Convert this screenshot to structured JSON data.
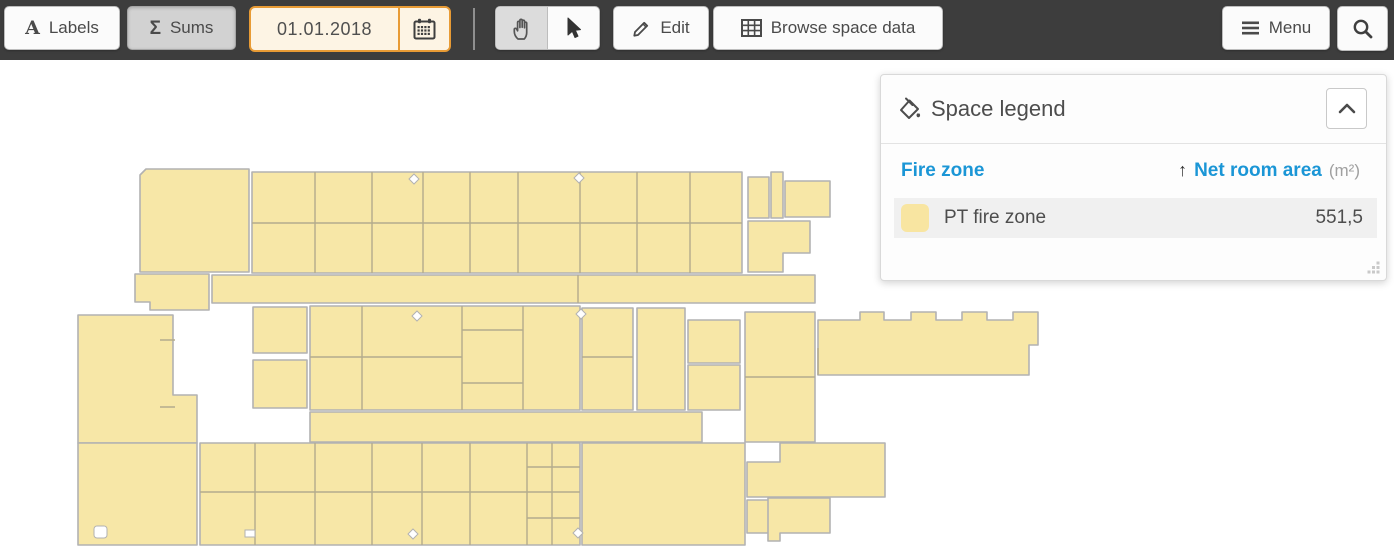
{
  "toolbar": {
    "labels": {
      "icon_glyph": "A",
      "label": "Labels"
    },
    "sums": {
      "icon_glyph": "Σ",
      "label": "Sums"
    },
    "date": {
      "value": "01.01.2018"
    },
    "edit": {
      "label": "Edit"
    },
    "browse": {
      "label": "Browse space data"
    },
    "menu": {
      "label": "Menu"
    }
  },
  "legend": {
    "title": "Space legend",
    "columns": {
      "name": "Fire zone",
      "sort_indicator": "↑",
      "value": "Net room area",
      "unit": "(m²)"
    },
    "rows": [
      {
        "name": "PT fire zone",
        "value": "551,5"
      }
    ]
  },
  "colors": {
    "accent_orange": "#e89b35",
    "toolbar_bg": "#3d3d3d",
    "legend_blue": "#1b96d6",
    "room_fill": "#f7e7a7",
    "room_stroke": "#b2b2b2",
    "room_line": "#b3ab8d",
    "swatch": "#f8e5a1",
    "row_bg": "#f0f0f0"
  }
}
